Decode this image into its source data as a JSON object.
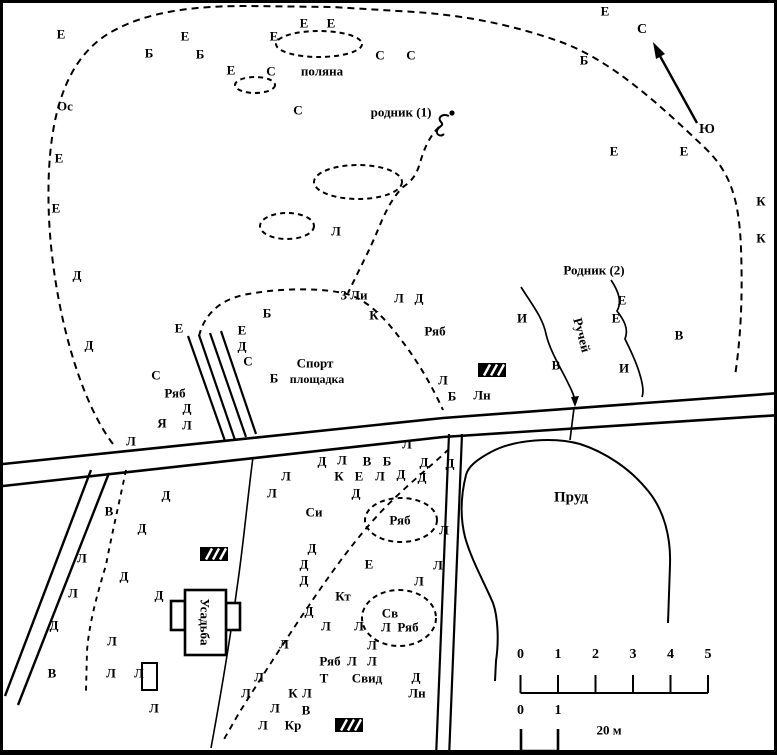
{
  "map": {
    "type": "hand-drawn park / estate site plan, black and white",
    "named": {
      "polyana": "поляна",
      "rodnik1": "родник (1)",
      "rodnik2": "Родник (2)",
      "ruchey": "Ручей",
      "sport_line1": "Спорт",
      "sport_line2": "площадка",
      "three_lindens": "3 Ли",
      "prud": "Пруд",
      "usadba": "Усадьба",
      "north": "С",
      "south": "Ю"
    },
    "scale_bar": {
      "major_ticks": [
        "0",
        "1",
        "2",
        "3",
        "4",
        "5"
      ],
      "minor_ticks": [
        "0",
        "1"
      ],
      "unit_label": "20 м"
    },
    "tree_labels": [
      {
        "t": "Е",
        "x": 58,
        "y": 31
      },
      {
        "t": "Е",
        "x": 182,
        "y": 33
      },
      {
        "t": "Б",
        "x": 146,
        "y": 50
      },
      {
        "t": "Б",
        "x": 197,
        "y": 51
      },
      {
        "t": "Е",
        "x": 271,
        "y": 33
      },
      {
        "t": "Е",
        "x": 301,
        "y": 20
      },
      {
        "t": "Е",
        "x": 328,
        "y": 20
      },
      {
        "t": "Е",
        "x": 228,
        "y": 67
      },
      {
        "t": "С",
        "x": 268,
        "y": 68
      },
      {
        "t": "С",
        "x": 377,
        "y": 52
      },
      {
        "t": "С",
        "x": 408,
        "y": 52
      },
      {
        "t": "Ос",
        "x": 62,
        "y": 103
      },
      {
        "t": "С",
        "x": 295,
        "y": 107
      },
      {
        "t": "Е",
        "x": 56,
        "y": 155
      },
      {
        "t": "Е",
        "x": 53,
        "y": 205
      },
      {
        "t": "Д",
        "x": 74,
        "y": 272
      },
      {
        "t": "Д",
        "x": 86,
        "y": 342
      },
      {
        "t": "Е",
        "x": 602,
        "y": 8
      },
      {
        "t": "Б",
        "x": 581,
        "y": 57
      },
      {
        "t": "Е",
        "x": 611,
        "y": 148
      },
      {
        "t": "Е",
        "x": 681,
        "y": 148
      },
      {
        "t": "К",
        "x": 758,
        "y": 198
      },
      {
        "t": "К",
        "x": 758,
        "y": 235
      },
      {
        "t": "Л",
        "x": 333,
        "y": 228
      },
      {
        "t": "Л",
        "x": 396,
        "y": 295
      },
      {
        "t": "Д",
        "x": 416,
        "y": 295
      },
      {
        "t": "Б",
        "x": 264,
        "y": 310
      },
      {
        "t": "К",
        "x": 371,
        "y": 312
      },
      {
        "t": "Ряб",
        "x": 432,
        "y": 328
      },
      {
        "t": "И",
        "x": 519,
        "y": 315
      },
      {
        "t": "Е",
        "x": 619,
        "y": 297
      },
      {
        "t": "Е",
        "x": 613,
        "y": 315
      },
      {
        "t": "В",
        "x": 676,
        "y": 332
      },
      {
        "t": "В",
        "x": 553,
        "y": 362
      },
      {
        "t": "И",
        "x": 621,
        "y": 365
      },
      {
        "t": "Е",
        "x": 176,
        "y": 325
      },
      {
        "t": "Е",
        "x": 239,
        "y": 327
      },
      {
        "t": "Д",
        "x": 239,
        "y": 343
      },
      {
        "t": "С",
        "x": 245,
        "y": 358
      },
      {
        "t": "Б",
        "x": 271,
        "y": 375
      },
      {
        "t": "С",
        "x": 153,
        "y": 372
      },
      {
        "t": "Ряб",
        "x": 172,
        "y": 390
      },
      {
        "t": "Д",
        "x": 184,
        "y": 405
      },
      {
        "t": "Я",
        "x": 159,
        "y": 420
      },
      {
        "t": "Л",
        "x": 184,
        "y": 422
      },
      {
        "t": "Л",
        "x": 128,
        "y": 438
      },
      {
        "t": "Л",
        "x": 440,
        "y": 377
      },
      {
        "t": "Б",
        "x": 449,
        "y": 393
      },
      {
        "t": "Лн",
        "x": 479,
        "y": 392
      },
      {
        "t": "Л",
        "x": 404,
        "y": 441
      },
      {
        "t": "Д",
        "x": 319,
        "y": 458
      },
      {
        "t": "Л",
        "x": 339,
        "y": 457
      },
      {
        "t": "В",
        "x": 364,
        "y": 458
      },
      {
        "t": "Б",
        "x": 384,
        "y": 458
      },
      {
        "t": "Д",
        "x": 421,
        "y": 459
      },
      {
        "t": "Д",
        "x": 447,
        "y": 460
      },
      {
        "t": "Л",
        "x": 283,
        "y": 473
      },
      {
        "t": "К",
        "x": 336,
        "y": 473
      },
      {
        "t": "Е",
        "x": 356,
        "y": 473
      },
      {
        "t": "Л",
        "x": 377,
        "y": 473
      },
      {
        "t": "Д",
        "x": 398,
        "y": 471
      },
      {
        "t": "Д",
        "x": 419,
        "y": 474
      },
      {
        "t": "Л",
        "x": 269,
        "y": 490
      },
      {
        "t": "Д",
        "x": 353,
        "y": 490
      },
      {
        "t": "Си",
        "x": 311,
        "y": 509
      },
      {
        "t": "Ряб",
        "x": 397,
        "y": 517
      },
      {
        "t": "Л",
        "x": 441,
        "y": 527
      },
      {
        "t": "В",
        "x": 106,
        "y": 508
      },
      {
        "t": "Д",
        "x": 163,
        "y": 492
      },
      {
        "t": "Д",
        "x": 139,
        "y": 525
      },
      {
        "t": "Л",
        "x": 79,
        "y": 555
      },
      {
        "t": "Д",
        "x": 121,
        "y": 573
      },
      {
        "t": "Л",
        "x": 70,
        "y": 590
      },
      {
        "t": "Д",
        "x": 156,
        "y": 592
      },
      {
        "t": "Д",
        "x": 51,
        "y": 622
      },
      {
        "t": "Л",
        "x": 109,
        "y": 638
      },
      {
        "t": "В",
        "x": 49,
        "y": 670
      },
      {
        "t": "Л",
        "x": 108,
        "y": 670
      },
      {
        "t": "Л",
        "x": 136,
        "y": 670
      },
      {
        "t": "Л",
        "x": 151,
        "y": 705
      },
      {
        "t": "Д",
        "x": 309,
        "y": 545
      },
      {
        "t": "Д",
        "x": 301,
        "y": 561
      },
      {
        "t": "Д",
        "x": 301,
        "y": 577
      },
      {
        "t": "Е",
        "x": 366,
        "y": 561
      },
      {
        "t": "Л",
        "x": 435,
        "y": 562
      },
      {
        "t": "Л",
        "x": 416,
        "y": 578
      },
      {
        "t": "Кт",
        "x": 340,
        "y": 593
      },
      {
        "t": "Д",
        "x": 306,
        "y": 608
      },
      {
        "t": "Л",
        "x": 323,
        "y": 623
      },
      {
        "t": "Л",
        "x": 356,
        "y": 623
      },
      {
        "t": "Св",
        "x": 387,
        "y": 610
      },
      {
        "t": "Л",
        "x": 383,
        "y": 624
      },
      {
        "t": "Ряб",
        "x": 405,
        "y": 624
      },
      {
        "t": "Л",
        "x": 281,
        "y": 641
      },
      {
        "t": "Л",
        "x": 369,
        "y": 642
      },
      {
        "t": "Ряб",
        "x": 327,
        "y": 658
      },
      {
        "t": "Л",
        "x": 349,
        "y": 658
      },
      {
        "t": "Л",
        "x": 369,
        "y": 658
      },
      {
        "t": "Т",
        "x": 321,
        "y": 675
      },
      {
        "t": "Свид",
        "x": 364,
        "y": 675
      },
      {
        "t": "Д",
        "x": 413,
        "y": 674
      },
      {
        "t": "Лн",
        "x": 414,
        "y": 690
      },
      {
        "t": "Л",
        "x": 256,
        "y": 674
      },
      {
        "t": "Л",
        "x": 243,
        "y": 690
      },
      {
        "t": "К",
        "x": 290,
        "y": 690
      },
      {
        "t": "Л",
        "x": 304,
        "y": 690
      },
      {
        "t": "Л",
        "x": 272,
        "y": 705
      },
      {
        "t": "В",
        "x": 303,
        "y": 707
      },
      {
        "t": "Л",
        "x": 260,
        "y": 722
      },
      {
        "t": "Кр",
        "x": 290,
        "y": 722
      }
    ]
  }
}
